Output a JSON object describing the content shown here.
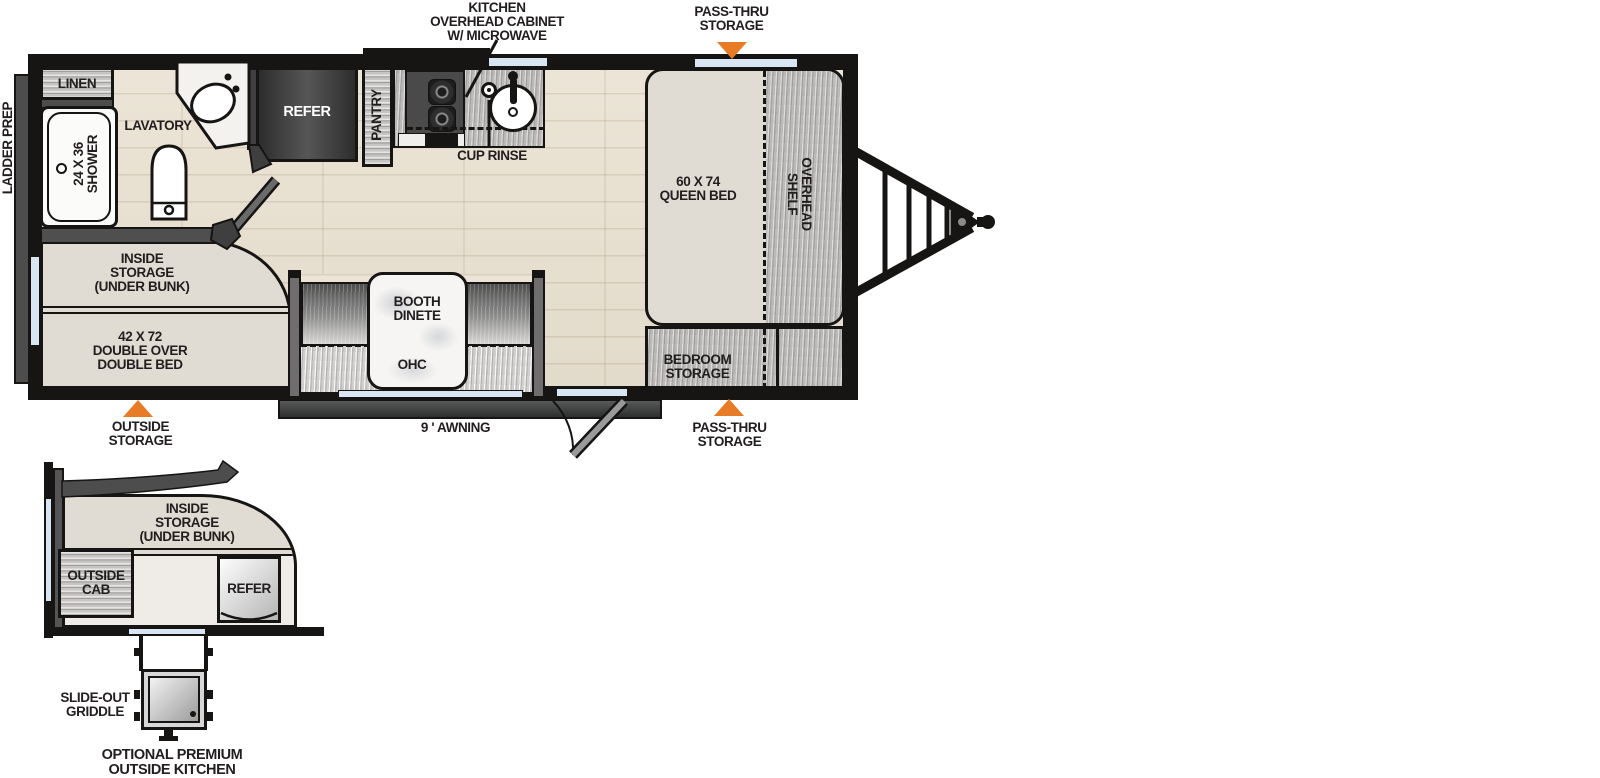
{
  "colors": {
    "accent_orange": "#e87b25",
    "wall_ink": "#161514",
    "window_blue": "#d8e5f3",
    "floor_wood": "#e8e1d3",
    "cabinet_gray": "#bab9b7",
    "bed_beige": "#e0dcd3",
    "dark_gray": "#4d4d4d",
    "refer_dark": "#3c3c3c",
    "label_ink": "#221e1f"
  },
  "callouts": {
    "kitchen_overhead": "KITCHEN\nOVERHEAD CABINET\nW/ MICROWAVE",
    "pass_thru_top": "PASS-THRU\nSTORAGE",
    "pass_thru_bottom": "PASS-THRU\nSTORAGE",
    "outside_storage": "OUTSIDE\nSTORAGE",
    "awning": "9 ' AWNING",
    "ladder_prep": "LADDER PREP"
  },
  "rooms": {
    "linen": "LINEN",
    "lavatory": "LAVATORY",
    "shower": "24 X 36\nSHOWER",
    "refer": "REFER",
    "pantry": "PANTRY",
    "cup_rinse": "CUP RINSE",
    "queen_bed": "60 X 74\nQUEEN BED",
    "overhead_shelf": "OVERHEAD\nSHELF",
    "inside_storage": "INSIDE\nSTORAGE\n(UNDER BUNK)",
    "double_bed": "42 X 72\nDOUBLE OVER\nDOUBLE BED",
    "booth_dinette": "BOOTH\nDINETE",
    "ohc": "OHC",
    "bedroom_storage": "BEDROOM\nSTORAGE"
  },
  "outside_kitchen": {
    "inside_storage": "INSIDE\nSTORAGE\n(UNDER BUNK)",
    "outside_cab": "OUTSIDE\nCAB",
    "refer": "REFER",
    "slide_out_griddle": "SLIDE-OUT\nGRIDDLE",
    "caption": "OPTIONAL PREMIUM\nOUTSIDE KITCHEN"
  }
}
